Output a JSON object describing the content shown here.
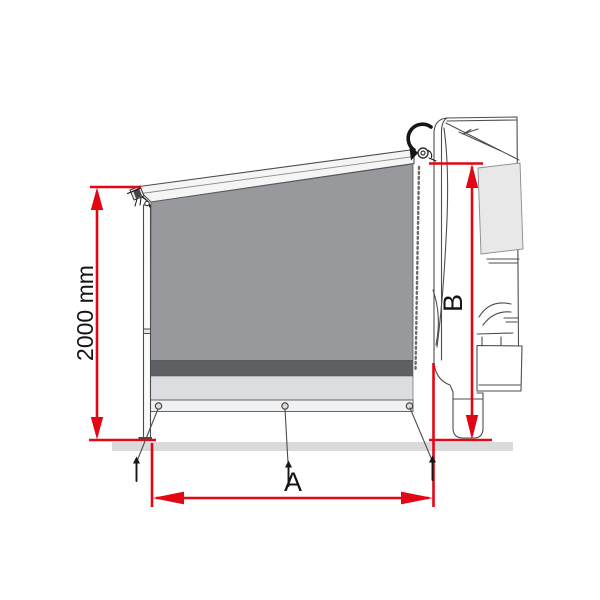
{
  "diagram": {
    "name": "awning-side-panel-dimension-diagram",
    "labels": {
      "height": "2000 mm",
      "width": "A",
      "wall_height": "B"
    },
    "colors": {
      "dimension_red": "#e30613",
      "panel_gray": "#97999c",
      "panel_dark_strip": "#5e6164",
      "panel_light_strip": "#dcdde0",
      "panel_bottom_band": "#f0f1f2",
      "roof_bar_white": "#f5f5f6",
      "window_gray": "#e8e8e9",
      "ground_shadow": "#dadada",
      "line_dark": "#4d4d4d"
    }
  }
}
